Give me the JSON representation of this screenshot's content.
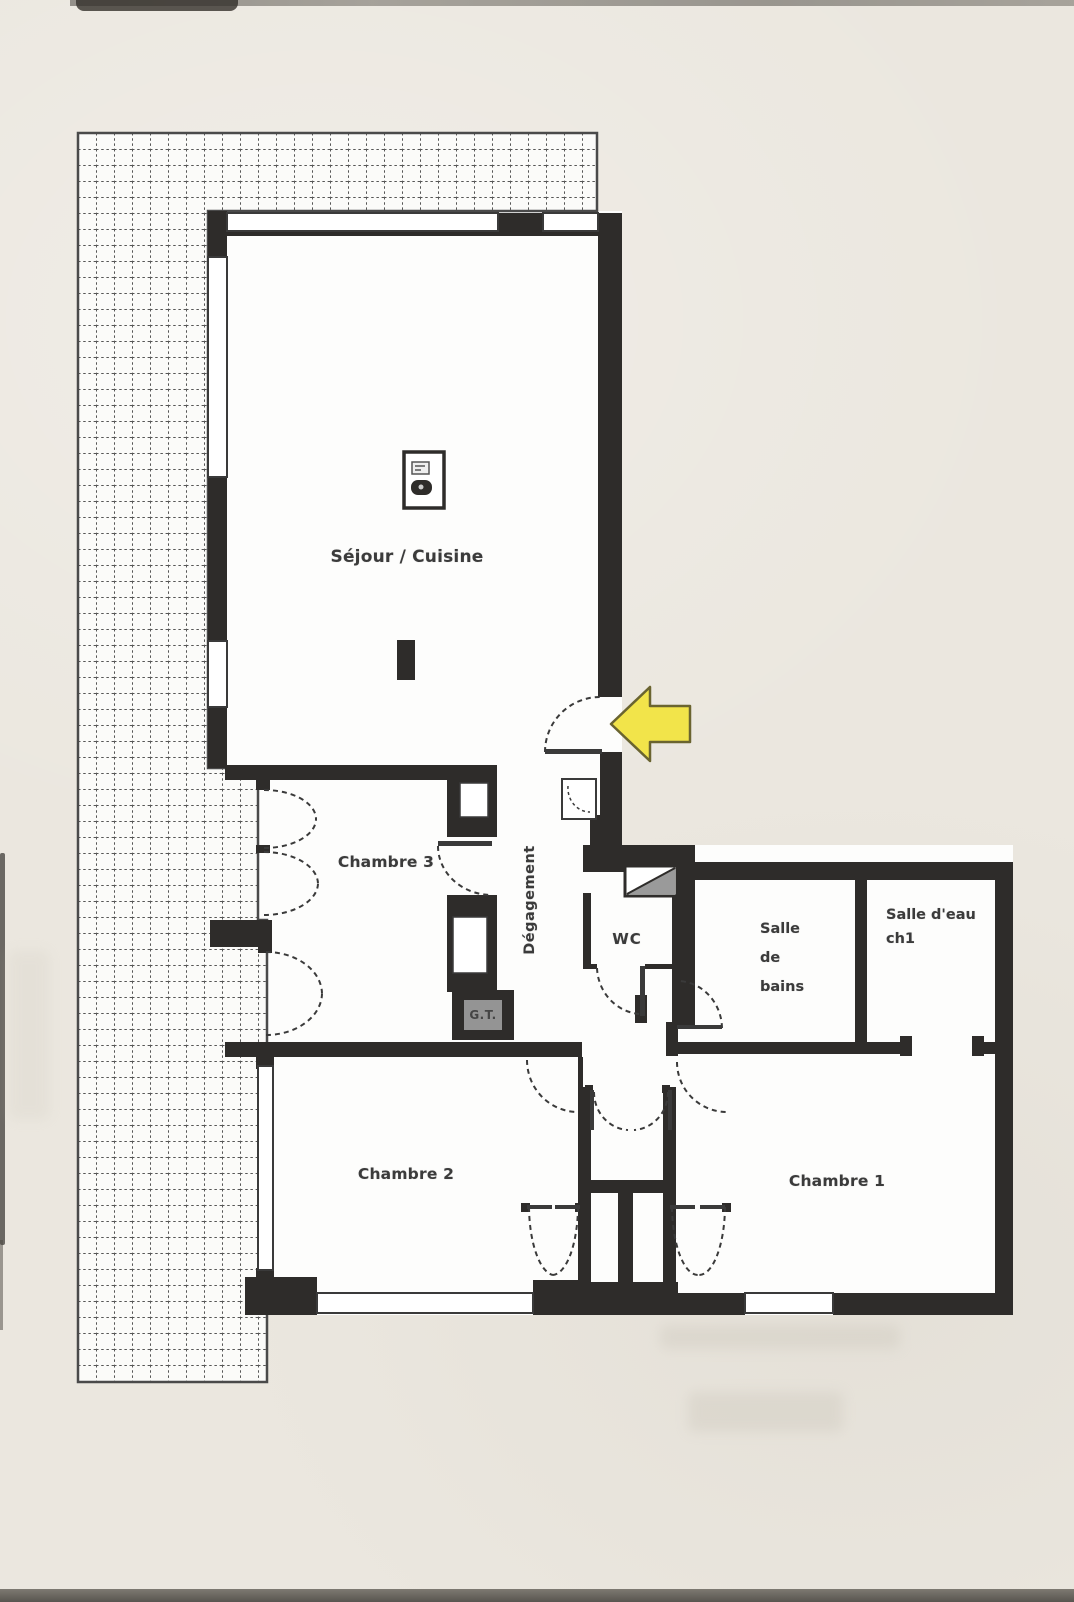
{
  "floorplan": {
    "rooms": {
      "sejour": {
        "label": "Séjour / Cuisine"
      },
      "chambre3": {
        "label": "Chambre 3"
      },
      "degagement": {
        "label": "Dégagement"
      },
      "wc": {
        "label": "WC"
      },
      "salle_de_bains": {
        "label": "Salle de bains",
        "lines": [
          "Salle",
          "de",
          "bains"
        ]
      },
      "salle_eau": {
        "label": "Salle d'eau ch1",
        "lines": [
          "Salle d'eau",
          "ch1"
        ]
      },
      "chambre2": {
        "label": "Chambre 2"
      },
      "chambre1": {
        "label": "Chambre 1"
      }
    },
    "annotations": {
      "technical_box": "G.T.",
      "entrance_arrow": "entrance-marker"
    },
    "colors": {
      "wall": "#2e2c2a",
      "paper": "#ebe7df",
      "floor": "#fdfdfc",
      "grid_line": "#3a3a3a",
      "arrow_fill": "#f2e44a",
      "arrow_outline": "#6a6430",
      "label": "#3b3b3b"
    }
  }
}
